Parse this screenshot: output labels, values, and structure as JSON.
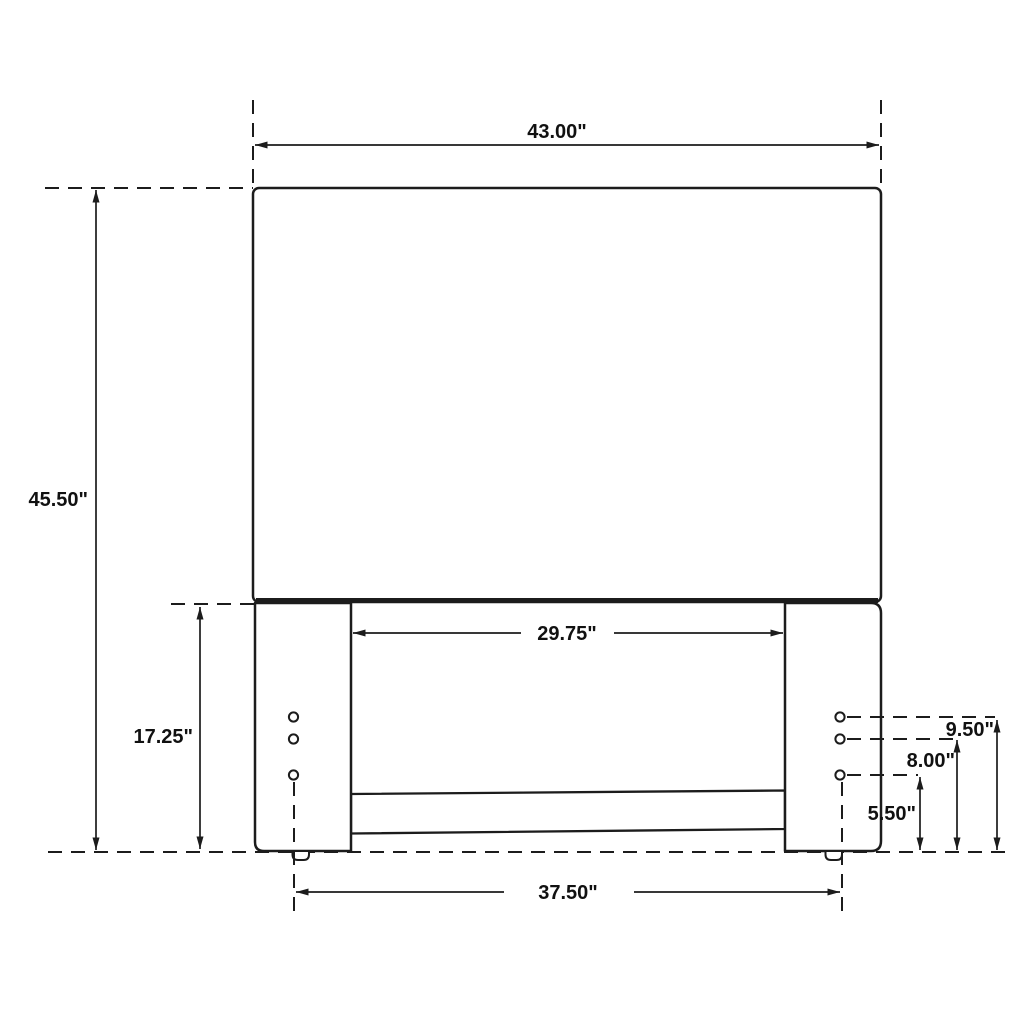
{
  "page": {
    "background": "#ffffff",
    "line_color": "#1c1c1c"
  },
  "drawing": {
    "type": "technical-dimension-drawing",
    "subject": "headboard-front-elevation",
    "units": "inches",
    "labels": {
      "overall_width": "43.00\"",
      "overall_height": "45.50\"",
      "leg_height": "17.25\"",
      "between_legs": "29.75\"",
      "between_feet": "37.50\"",
      "hole_top_height": "9.50\"",
      "hole_middle_height": "8.00\"",
      "hole_bottom_height": "5.50\""
    },
    "features": {
      "legs": 2,
      "holes_per_leg": 3,
      "cross_rails": 1
    }
  }
}
